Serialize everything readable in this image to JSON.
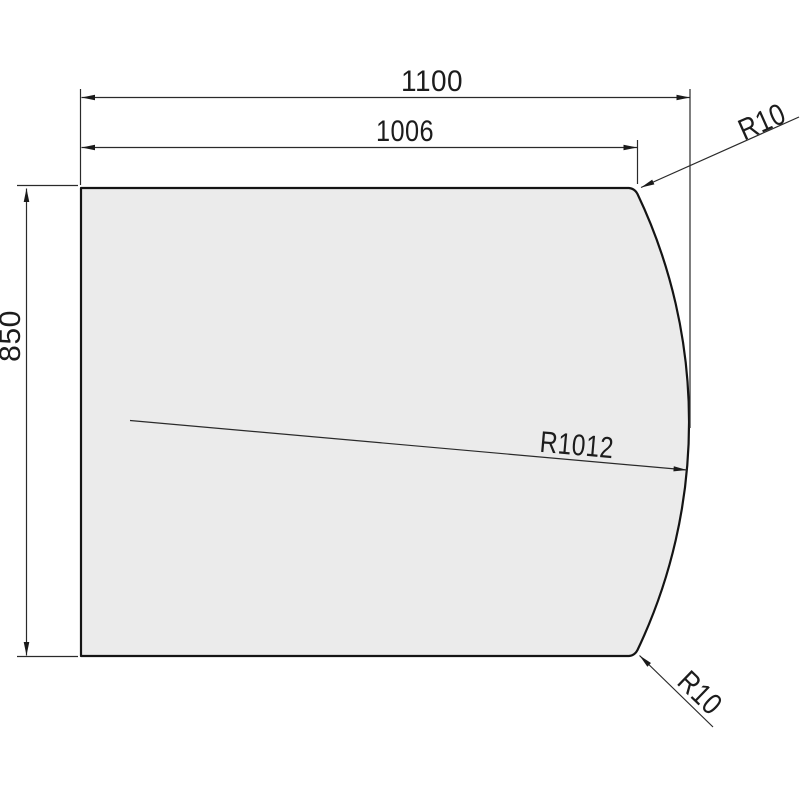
{
  "drawing": {
    "type": "technical-drawing",
    "description": "flat panel with one convex curved edge, dimensioned",
    "colors": {
      "background": "#ffffff",
      "panel_fill": "#ebebeb",
      "outline": "#141414",
      "dimension_line": "#2a2a2a"
    },
    "dimensions": {
      "overall_width": {
        "label": "1100"
      },
      "flat_edge_width": {
        "label": "1006"
      },
      "height": {
        "label": "850"
      },
      "top_corner_radius": {
        "label": "R10"
      },
      "front_edge_radius": {
        "label": "R1012"
      },
      "bottom_corner_radius": {
        "label": "R10"
      }
    }
  }
}
